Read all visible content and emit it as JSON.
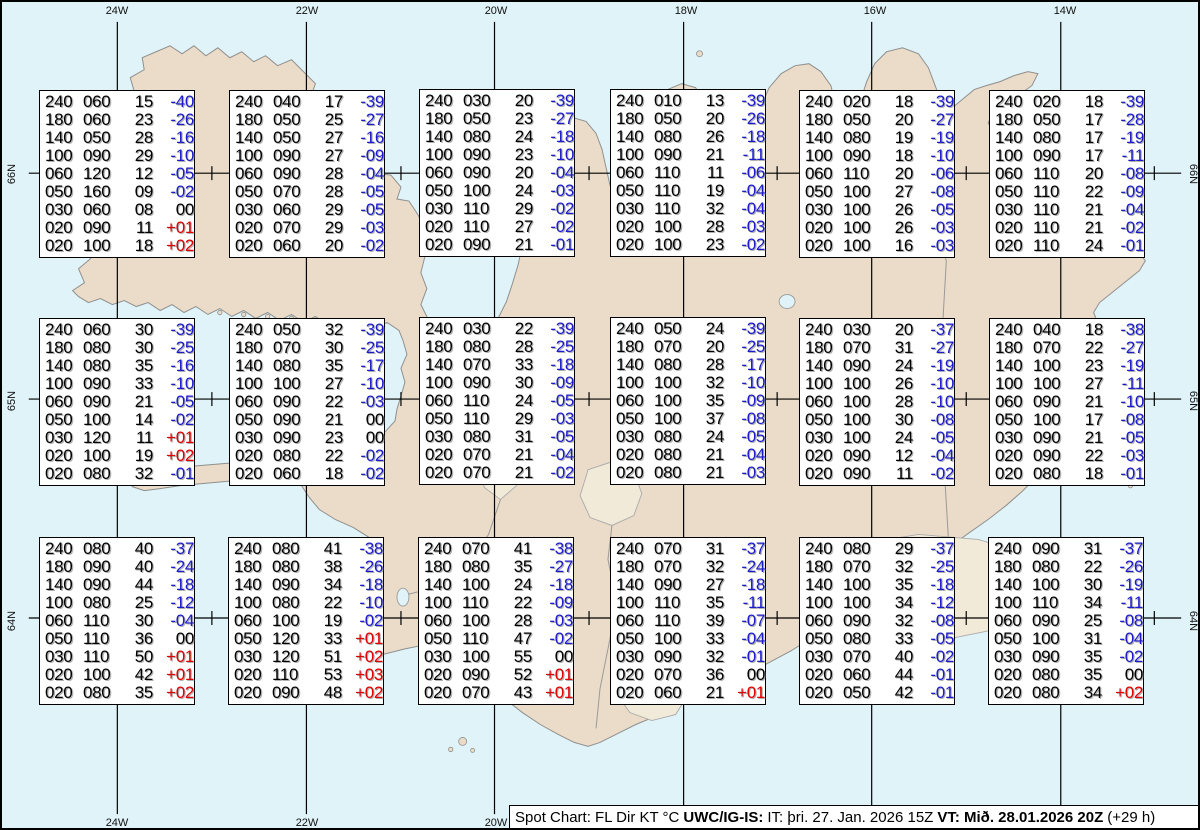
{
  "map": {
    "region": "Iceland",
    "top_longitude_labels": [
      {
        "text": "24W",
        "x": 115
      },
      {
        "text": "22W",
        "x": 305
      },
      {
        "text": "20W",
        "x": 494
      },
      {
        "text": "18W",
        "x": 684
      },
      {
        "text": "16W",
        "x": 873
      },
      {
        "text": "14W",
        "x": 1063
      }
    ],
    "bottom_longitude_labels": [
      {
        "text": "24W",
        "x": 115
      },
      {
        "text": "22W",
        "x": 305
      },
      {
        "text": "20W",
        "x": 494
      }
    ],
    "left_latitude_labels": [
      {
        "text": "66N",
        "y": 172
      },
      {
        "text": "65N",
        "y": 399
      },
      {
        "text": "64N",
        "y": 619
      }
    ],
    "right_latitude_labels": [
      {
        "text": "66N",
        "y": 172
      },
      {
        "text": "65N",
        "y": 399
      },
      {
        "text": "64N",
        "y": 619
      }
    ],
    "colors": {
      "ocean": "#E0F3F8",
      "land": "#EADCC8",
      "coastline": "#8F8F8F",
      "glacier": "#F1EAD9",
      "grid": "#000000"
    }
  },
  "value_columns": [
    "FL",
    "Dir",
    "KT",
    "°C"
  ],
  "value_colors": {
    "wind_text": "#000000",
    "temp_negative": "#1C1CCB",
    "temp_positive": "#E00000",
    "temp_zero": "#000000"
  },
  "stations": [
    {
      "x": 37,
      "y": 88,
      "rows": [
        [
          "240",
          "060",
          "15",
          "-40"
        ],
        [
          "180",
          "060",
          "23",
          "-26"
        ],
        [
          "140",
          "050",
          "28",
          "-16"
        ],
        [
          "100",
          "090",
          "29",
          "-10"
        ],
        [
          "060",
          "120",
          "12",
          "-05"
        ],
        [
          "050",
          "160",
          "09",
          "-02"
        ],
        [
          "030",
          "060",
          "08",
          "00"
        ],
        [
          "020",
          "090",
          "11",
          "+01"
        ],
        [
          "020",
          "100",
          "18",
          "+02"
        ]
      ]
    },
    {
      "x": 227,
      "y": 88,
      "rows": [
        [
          "240",
          "040",
          "17",
          "-39"
        ],
        [
          "180",
          "050",
          "25",
          "-27"
        ],
        [
          "140",
          "050",
          "27",
          "-16"
        ],
        [
          "100",
          "090",
          "27",
          "-09"
        ],
        [
          "060",
          "090",
          "28",
          "-04"
        ],
        [
          "050",
          "070",
          "28",
          "-05"
        ],
        [
          "030",
          "060",
          "29",
          "-05"
        ],
        [
          "020",
          "070",
          "29",
          "-03"
        ],
        [
          "020",
          "060",
          "20",
          "-02"
        ]
      ]
    },
    {
      "x": 417,
      "y": 87,
      "rows": [
        [
          "240",
          "030",
          "20",
          "-39"
        ],
        [
          "180",
          "050",
          "23",
          "-27"
        ],
        [
          "140",
          "080",
          "24",
          "-18"
        ],
        [
          "100",
          "090",
          "23",
          "-10"
        ],
        [
          "060",
          "090",
          "20",
          "-04"
        ],
        [
          "050",
          "100",
          "24",
          "-03"
        ],
        [
          "030",
          "110",
          "29",
          "-02"
        ],
        [
          "020",
          "110",
          "27",
          "-02"
        ],
        [
          "020",
          "090",
          "21",
          "-01"
        ]
      ]
    },
    {
      "x": 608,
      "y": 87,
      "rows": [
        [
          "240",
          "010",
          "13",
          "-39"
        ],
        [
          "180",
          "050",
          "20",
          "-26"
        ],
        [
          "140",
          "080",
          "26",
          "-18"
        ],
        [
          "100",
          "090",
          "21",
          "-11"
        ],
        [
          "060",
          "110",
          "11",
          "-06"
        ],
        [
          "050",
          "110",
          "19",
          "-04"
        ],
        [
          "030",
          "110",
          "32",
          "-04"
        ],
        [
          "020",
          "100",
          "28",
          "-03"
        ],
        [
          "020",
          "100",
          "23",
          "-02"
        ]
      ]
    },
    {
      "x": 797,
      "y": 88,
      "rows": [
        [
          "240",
          "020",
          "18",
          "-39"
        ],
        [
          "180",
          "050",
          "20",
          "-27"
        ],
        [
          "140",
          "080",
          "19",
          "-19"
        ],
        [
          "100",
          "090",
          "18",
          "-10"
        ],
        [
          "060",
          "110",
          "20",
          "-06"
        ],
        [
          "050",
          "100",
          "27",
          "-08"
        ],
        [
          "030",
          "100",
          "26",
          "-05"
        ],
        [
          "020",
          "100",
          "26",
          "-03"
        ],
        [
          "020",
          "100",
          "16",
          "-03"
        ]
      ]
    },
    {
      "x": 987,
      "y": 88,
      "rows": [
        [
          "240",
          "020",
          "18",
          "-39"
        ],
        [
          "180",
          "050",
          "17",
          "-28"
        ],
        [
          "140",
          "080",
          "17",
          "-19"
        ],
        [
          "100",
          "090",
          "17",
          "-11"
        ],
        [
          "060",
          "110",
          "20",
          "-08"
        ],
        [
          "050",
          "110",
          "22",
          "-09"
        ],
        [
          "030",
          "110",
          "21",
          "-04"
        ],
        [
          "020",
          "110",
          "21",
          "-02"
        ],
        [
          "020",
          "110",
          "24",
          "-01"
        ]
      ]
    },
    {
      "x": 37,
      "y": 316,
      "rows": [
        [
          "240",
          "060",
          "30",
          "-39"
        ],
        [
          "180",
          "080",
          "30",
          "-25"
        ],
        [
          "140",
          "080",
          "35",
          "-16"
        ],
        [
          "100",
          "090",
          "33",
          "-10"
        ],
        [
          "060",
          "090",
          "21",
          "-05"
        ],
        [
          "050",
          "100",
          "14",
          "-02"
        ],
        [
          "030",
          "120",
          "11",
          "+01"
        ],
        [
          "020",
          "100",
          "19",
          "+02"
        ],
        [
          "020",
          "080",
          "32",
          "-01"
        ]
      ]
    },
    {
      "x": 227,
      "y": 316,
      "rows": [
        [
          "240",
          "050",
          "32",
          "-39"
        ],
        [
          "180",
          "070",
          "30",
          "-25"
        ],
        [
          "140",
          "080",
          "35",
          "-17"
        ],
        [
          "100",
          "100",
          "27",
          "-10"
        ],
        [
          "060",
          "090",
          "22",
          "-03"
        ],
        [
          "050",
          "090",
          "21",
          "00"
        ],
        [
          "030",
          "090",
          "23",
          "00"
        ],
        [
          "020",
          "080",
          "22",
          "-02"
        ],
        [
          "020",
          "060",
          "18",
          "-02"
        ]
      ]
    },
    {
      "x": 417,
      "y": 315,
      "rows": [
        [
          "240",
          "030",
          "22",
          "-39"
        ],
        [
          "180",
          "080",
          "28",
          "-25"
        ],
        [
          "140",
          "070",
          "33",
          "-18"
        ],
        [
          "100",
          "090",
          "30",
          "-09"
        ],
        [
          "060",
          "110",
          "24",
          "-05"
        ],
        [
          "050",
          "110",
          "29",
          "-03"
        ],
        [
          "030",
          "080",
          "31",
          "-05"
        ],
        [
          "020",
          "070",
          "21",
          "-04"
        ],
        [
          "020",
          "070",
          "21",
          "-02"
        ]
      ]
    },
    {
      "x": 608,
      "y": 315,
      "rows": [
        [
          "240",
          "050",
          "24",
          "-39"
        ],
        [
          "180",
          "070",
          "20",
          "-25"
        ],
        [
          "140",
          "080",
          "28",
          "-17"
        ],
        [
          "100",
          "100",
          "32",
          "-10"
        ],
        [
          "060",
          "100",
          "35",
          "-09"
        ],
        [
          "050",
          "100",
          "37",
          "-08"
        ],
        [
          "030",
          "080",
          "24",
          "-05"
        ],
        [
          "020",
          "080",
          "21",
          "-04"
        ],
        [
          "020",
          "080",
          "21",
          "-03"
        ]
      ]
    },
    {
      "x": 797,
      "y": 316,
      "rows": [
        [
          "240",
          "030",
          "20",
          "-37"
        ],
        [
          "180",
          "070",
          "31",
          "-27"
        ],
        [
          "140",
          "090",
          "24",
          "-19"
        ],
        [
          "100",
          "100",
          "26",
          "-10"
        ],
        [
          "060",
          "100",
          "28",
          "-10"
        ],
        [
          "050",
          "100",
          "30",
          "-08"
        ],
        [
          "030",
          "100",
          "24",
          "-05"
        ],
        [
          "020",
          "090",
          "12",
          "-04"
        ],
        [
          "020",
          "090",
          "11",
          "-02"
        ]
      ]
    },
    {
      "x": 987,
      "y": 316,
      "rows": [
        [
          "240",
          "040",
          "18",
          "-38"
        ],
        [
          "180",
          "070",
          "22",
          "-27"
        ],
        [
          "140",
          "100",
          "23",
          "-19"
        ],
        [
          "100",
          "100",
          "27",
          "-11"
        ],
        [
          "060",
          "090",
          "21",
          "-10"
        ],
        [
          "050",
          "100",
          "17",
          "-08"
        ],
        [
          "030",
          "090",
          "21",
          "-05"
        ],
        [
          "020",
          "090",
          "22",
          "-03"
        ],
        [
          "020",
          "080",
          "18",
          "-01"
        ]
      ]
    },
    {
      "x": 37,
      "y": 535,
      "rows": [
        [
          "240",
          "080",
          "40",
          "-37"
        ],
        [
          "180",
          "090",
          "40",
          "-24"
        ],
        [
          "140",
          "090",
          "44",
          "-18"
        ],
        [
          "100",
          "080",
          "25",
          "-12"
        ],
        [
          "060",
          "110",
          "30",
          "-04"
        ],
        [
          "050",
          "110",
          "36",
          "00"
        ],
        [
          "030",
          "110",
          "50",
          "+01"
        ],
        [
          "020",
          "100",
          "42",
          "+01"
        ],
        [
          "020",
          "080",
          "35",
          "+02"
        ]
      ]
    },
    {
      "x": 226,
      "y": 535,
      "rows": [
        [
          "240",
          "080",
          "41",
          "-38"
        ],
        [
          "180",
          "080",
          "38",
          "-26"
        ],
        [
          "140",
          "090",
          "34",
          "-18"
        ],
        [
          "100",
          "080",
          "22",
          "-10"
        ],
        [
          "060",
          "100",
          "19",
          "-02"
        ],
        [
          "050",
          "120",
          "33",
          "+01"
        ],
        [
          "030",
          "120",
          "51",
          "+02"
        ],
        [
          "020",
          "110",
          "53",
          "+03"
        ],
        [
          "020",
          "090",
          "48",
          "+02"
        ]
      ]
    },
    {
      "x": 416,
      "y": 535,
      "rows": [
        [
          "240",
          "070",
          "41",
          "-38"
        ],
        [
          "180",
          "080",
          "35",
          "-27"
        ],
        [
          "140",
          "100",
          "24",
          "-18"
        ],
        [
          "100",
          "110",
          "22",
          "-09"
        ],
        [
          "060",
          "100",
          "28",
          "-03"
        ],
        [
          "050",
          "110",
          "47",
          "-02"
        ],
        [
          "030",
          "100",
          "55",
          "00"
        ],
        [
          "020",
          "090",
          "52",
          "+01"
        ],
        [
          "020",
          "070",
          "43",
          "+01"
        ]
      ]
    },
    {
      "x": 608,
      "y": 535,
      "rows": [
        [
          "240",
          "070",
          "31",
          "-37"
        ],
        [
          "180",
          "070",
          "32",
          "-24"
        ],
        [
          "140",
          "090",
          "27",
          "-18"
        ],
        [
          "100",
          "110",
          "35",
          "-11"
        ],
        [
          "060",
          "110",
          "39",
          "-07"
        ],
        [
          "050",
          "100",
          "33",
          "-04"
        ],
        [
          "030",
          "090",
          "32",
          "-01"
        ],
        [
          "020",
          "070",
          "36",
          "00"
        ],
        [
          "020",
          "060",
          "21",
          "+01"
        ]
      ]
    },
    {
      "x": 797,
      "y": 535,
      "rows": [
        [
          "240",
          "080",
          "29",
          "-37"
        ],
        [
          "180",
          "070",
          "32",
          "-25"
        ],
        [
          "140",
          "100",
          "35",
          "-18"
        ],
        [
          "100",
          "100",
          "34",
          "-12"
        ],
        [
          "060",
          "090",
          "32",
          "-08"
        ],
        [
          "050",
          "080",
          "33",
          "-05"
        ],
        [
          "030",
          "070",
          "40",
          "-02"
        ],
        [
          "020",
          "060",
          "44",
          "-01"
        ],
        [
          "020",
          "050",
          "42",
          "-01"
        ]
      ]
    },
    {
      "x": 986,
      "y": 535,
      "rows": [
        [
          "240",
          "090",
          "31",
          "-37"
        ],
        [
          "180",
          "080",
          "22",
          "-26"
        ],
        [
          "140",
          "100",
          "30",
          "-19"
        ],
        [
          "100",
          "110",
          "34",
          "-11"
        ],
        [
          "060",
          "090",
          "25",
          "-08"
        ],
        [
          "050",
          "100",
          "31",
          "-04"
        ],
        [
          "030",
          "090",
          "35",
          "-02"
        ],
        [
          "020",
          "080",
          "35",
          "00"
        ],
        [
          "020",
          "080",
          "34",
          "+02"
        ]
      ]
    }
  ],
  "footer": {
    "chart_label": "Spot Chart: FL Dir KT °C",
    "product": "UWC/IG-IS:",
    "issue_time": "IT: þri. 27. Jan. 2026 15Z",
    "valid_time": "VT: Mið. 28.01.2026 20Z",
    "lead_time": "(+29 h)"
  }
}
